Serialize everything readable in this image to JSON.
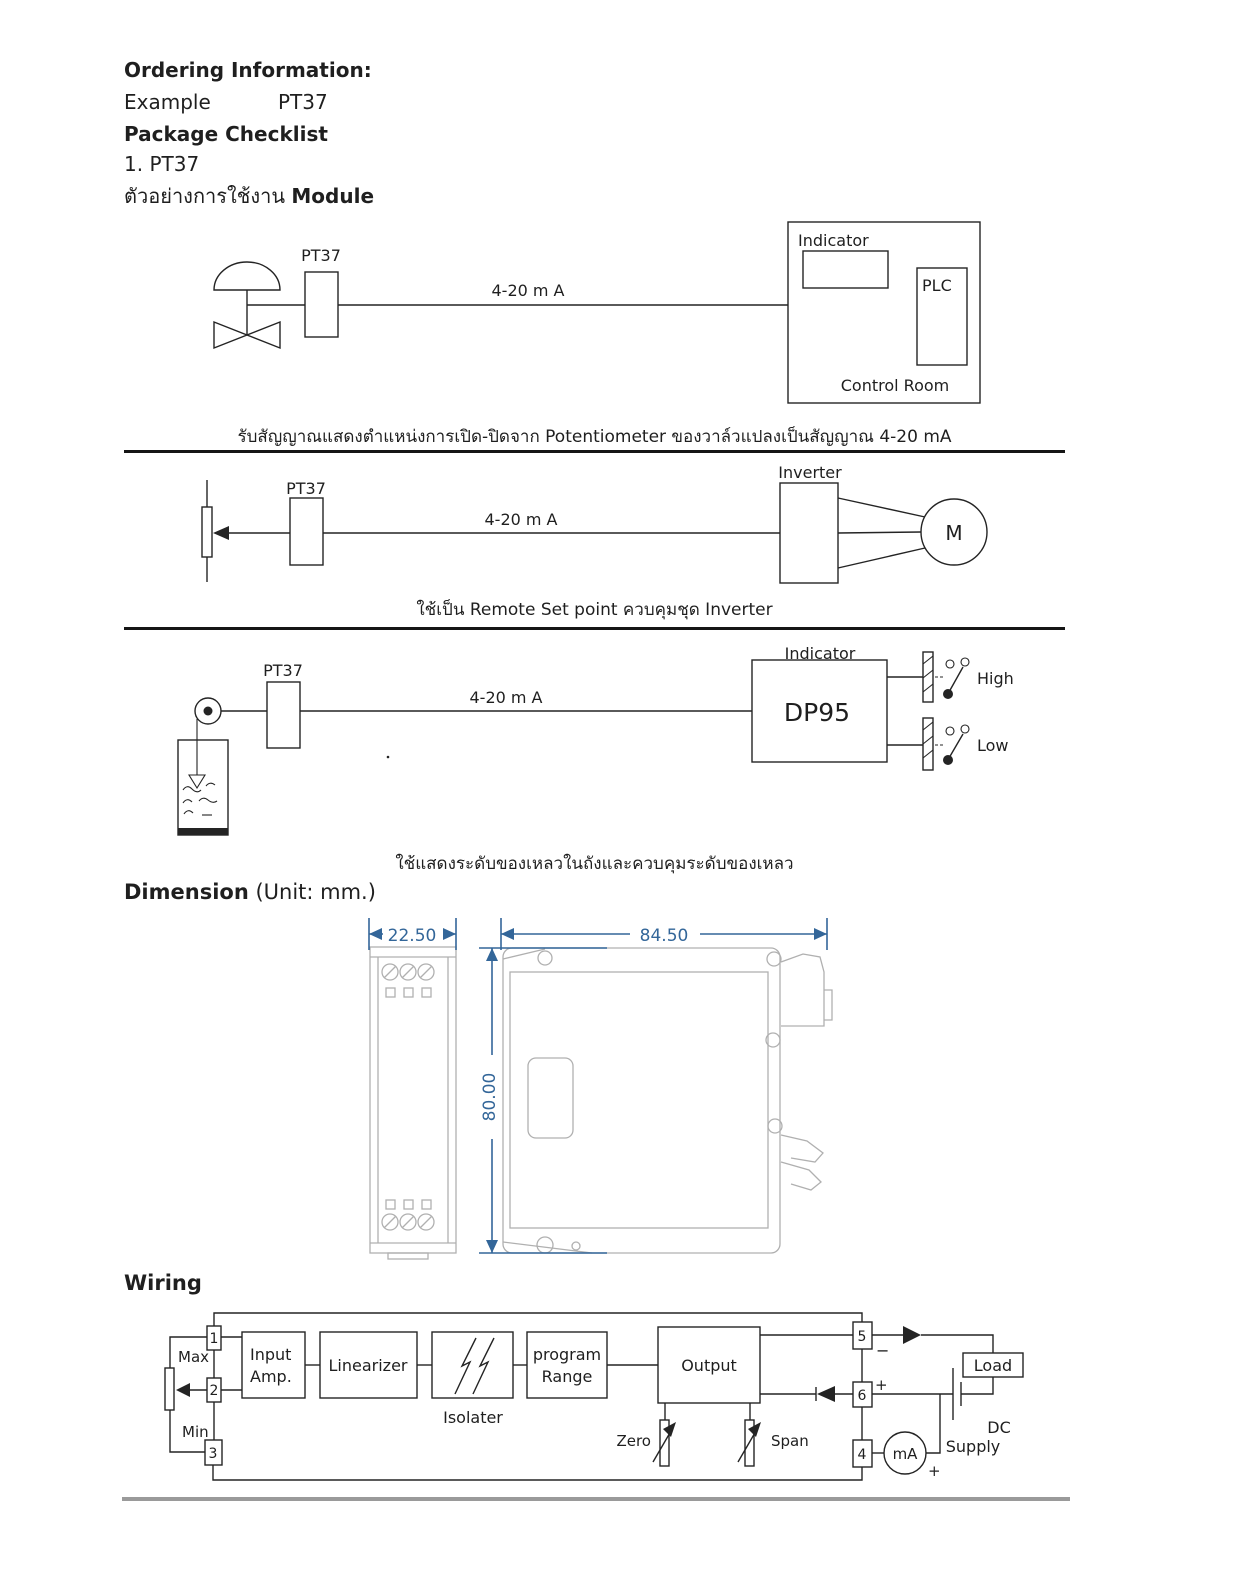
{
  "page": {
    "bg": "#ffffff",
    "ink": "#1f1f1f",
    "accent_blue": "#336699",
    "outline_gray": "#b0b0b0"
  },
  "header": {
    "ordering_title": "Ordering Information:",
    "example_label": "Example",
    "example_value": "PT37",
    "package_title": "Package Checklist",
    "package_item": "1. PT37",
    "usage_title_thai": "ตัวอย่างการใช้งาน",
    "usage_title_en": "Module"
  },
  "app1": {
    "module": "PT37",
    "signal": "4-20 m A",
    "indicator": "Indicator",
    "plc": "PLC",
    "room": "Control Room",
    "caption": "รับสัญญาณแสดงตำแหน่งการเปิด-ปิดจาก Potentiometer ของวาล์วแปลงเป็นสัญญาณ 4-20 mA"
  },
  "app2": {
    "module": "PT37",
    "signal": "4-20 m A",
    "inverter": "Inverter",
    "motor": "M",
    "caption": "ใช้เป็น Remote Set point ควบคุมชุด Inverter"
  },
  "app3": {
    "module": "PT37",
    "signal": "4-20 m A",
    "indicator": "Indicator",
    "display": "DP95",
    "high": "High",
    "low": "Low",
    "caption": "ใช้แสดงระดับของเหลวในถังและควบคุมระดับของเหลว"
  },
  "dimension": {
    "heading": "Dimension",
    "heading_unit": " (Unit: mm.)",
    "front_width": "22.50",
    "side_width": "84.50",
    "side_height": "80.00"
  },
  "wiring": {
    "heading": "Wiring",
    "t1": "1",
    "t2": "2",
    "t3": "3",
    "t4": "4",
    "t5": "5",
    "t6": "6",
    "max": "Max",
    "min": "Min",
    "input_amp_1": "Input",
    "input_amp_2": "Amp.",
    "linearizer": "Linearizer",
    "isolator": "Isolater",
    "program_1": "program",
    "program_2": "Range",
    "output": "Output",
    "zero": "Zero",
    "span": "Span",
    "load": "Load",
    "dc_1": "DC",
    "dc_2": "Supply",
    "meter": "mA",
    "plus": "+",
    "minus": "−"
  }
}
